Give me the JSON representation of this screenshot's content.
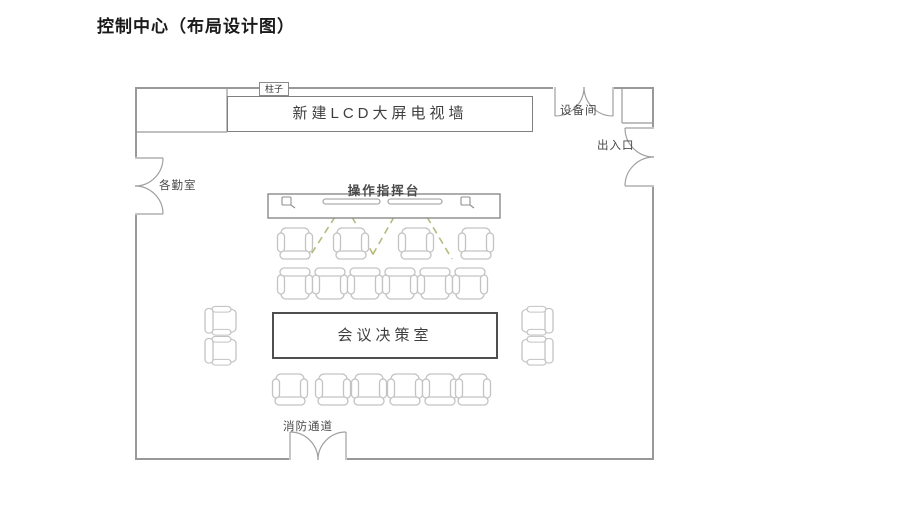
{
  "page": {
    "title": "控制中心（布局设计图）"
  },
  "floor_plan": {
    "labels": {
      "pillar": "柱子",
      "lcd_wall": "新建LCD大屏电视墙",
      "equipment_room": "设备间",
      "entrance": "出入口",
      "duty_room": "各勤室",
      "console": "操作指挥台",
      "meeting_room": "会议决策室",
      "fire_exit": "消防通道"
    },
    "icons": {
      "console_left": "device-icon",
      "console_right": "device-icon"
    },
    "furniture": {
      "console_desks": 2,
      "chair_rows": [
        4,
        6,
        6
      ],
      "side_chairs_left": 2,
      "side_chairs_right": 2
    },
    "colors": {
      "wall": "#999999",
      "inner_line": "#8a8a8a",
      "furniture_line": "#c3c3c3",
      "table_border": "#4f4f4f",
      "beam_dash": "#b8ba7d",
      "label_text": "#4a4a4a"
    }
  }
}
